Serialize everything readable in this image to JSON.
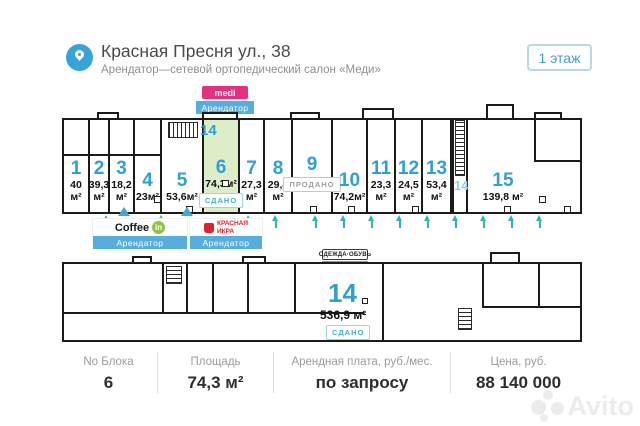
{
  "header": {
    "title": "Красная Пресня ул., 38",
    "subtitle": "Арендатор—сетевой ортопедический салон «Меди»",
    "floor_badge": "1 этаж"
  },
  "callouts": {
    "tenant_label": "Арендатор",
    "medi": "medi",
    "coffee": "Coffee",
    "coffee_badge": "in",
    "ikra_line1": "КРАСНАЯ",
    "ikra_line2": "ИКРА",
    "odezhda": "ОДЕЖДА·ОБУВЬ"
  },
  "plan1": {
    "stair_top": "14",
    "stair_bottom": "14",
    "units": [
      {
        "number": "1",
        "area": "40 м²"
      },
      {
        "number": "2",
        "area": "39,3 м²"
      },
      {
        "number": "3",
        "area": "18,2 м²"
      },
      {
        "number": "4",
        "area": "23м²"
      },
      {
        "number": "5",
        "area": "53,6м²"
      },
      {
        "number": "6",
        "area": "74,3м²",
        "status": "СДАНО"
      },
      {
        "number": "7",
        "area": "27,3 м²"
      },
      {
        "number": "8",
        "area": "29,4 м²"
      },
      {
        "number": "9",
        "status": "ПРОДАНО"
      },
      {
        "number": "10",
        "area": "74,2м²"
      },
      {
        "number": "11",
        "area": "23,3 м²"
      },
      {
        "number": "12",
        "area": "24,5 м²"
      },
      {
        "number": "13",
        "area": "53,4 м²"
      },
      {
        "number": "15",
        "area": "139,8 м²"
      }
    ]
  },
  "plan2": {
    "number": "14",
    "area": "536,9 м²",
    "status": "СДАНО"
  },
  "info_bar": {
    "columns": [
      {
        "label": "No Блока",
        "value": "6"
      },
      {
        "label": "Площадь",
        "value": "74,3 м²"
      },
      {
        "label": "Арендная плата, руб./мес.",
        "value": "по запросу"
      },
      {
        "label": "Цена, руб.",
        "value": "88 140 000"
      }
    ]
  },
  "watermark": {
    "text": "Avito"
  },
  "colors": {
    "accent_blue": "#2f9fd6",
    "teal": "#2eb4b4",
    "green_fill": "#dcedc7",
    "medi_pink": "#e4317f",
    "tenant_blue": "#57aedd",
    "coffee_green": "#8cc63e",
    "ikra_red": "#d8232a"
  }
}
